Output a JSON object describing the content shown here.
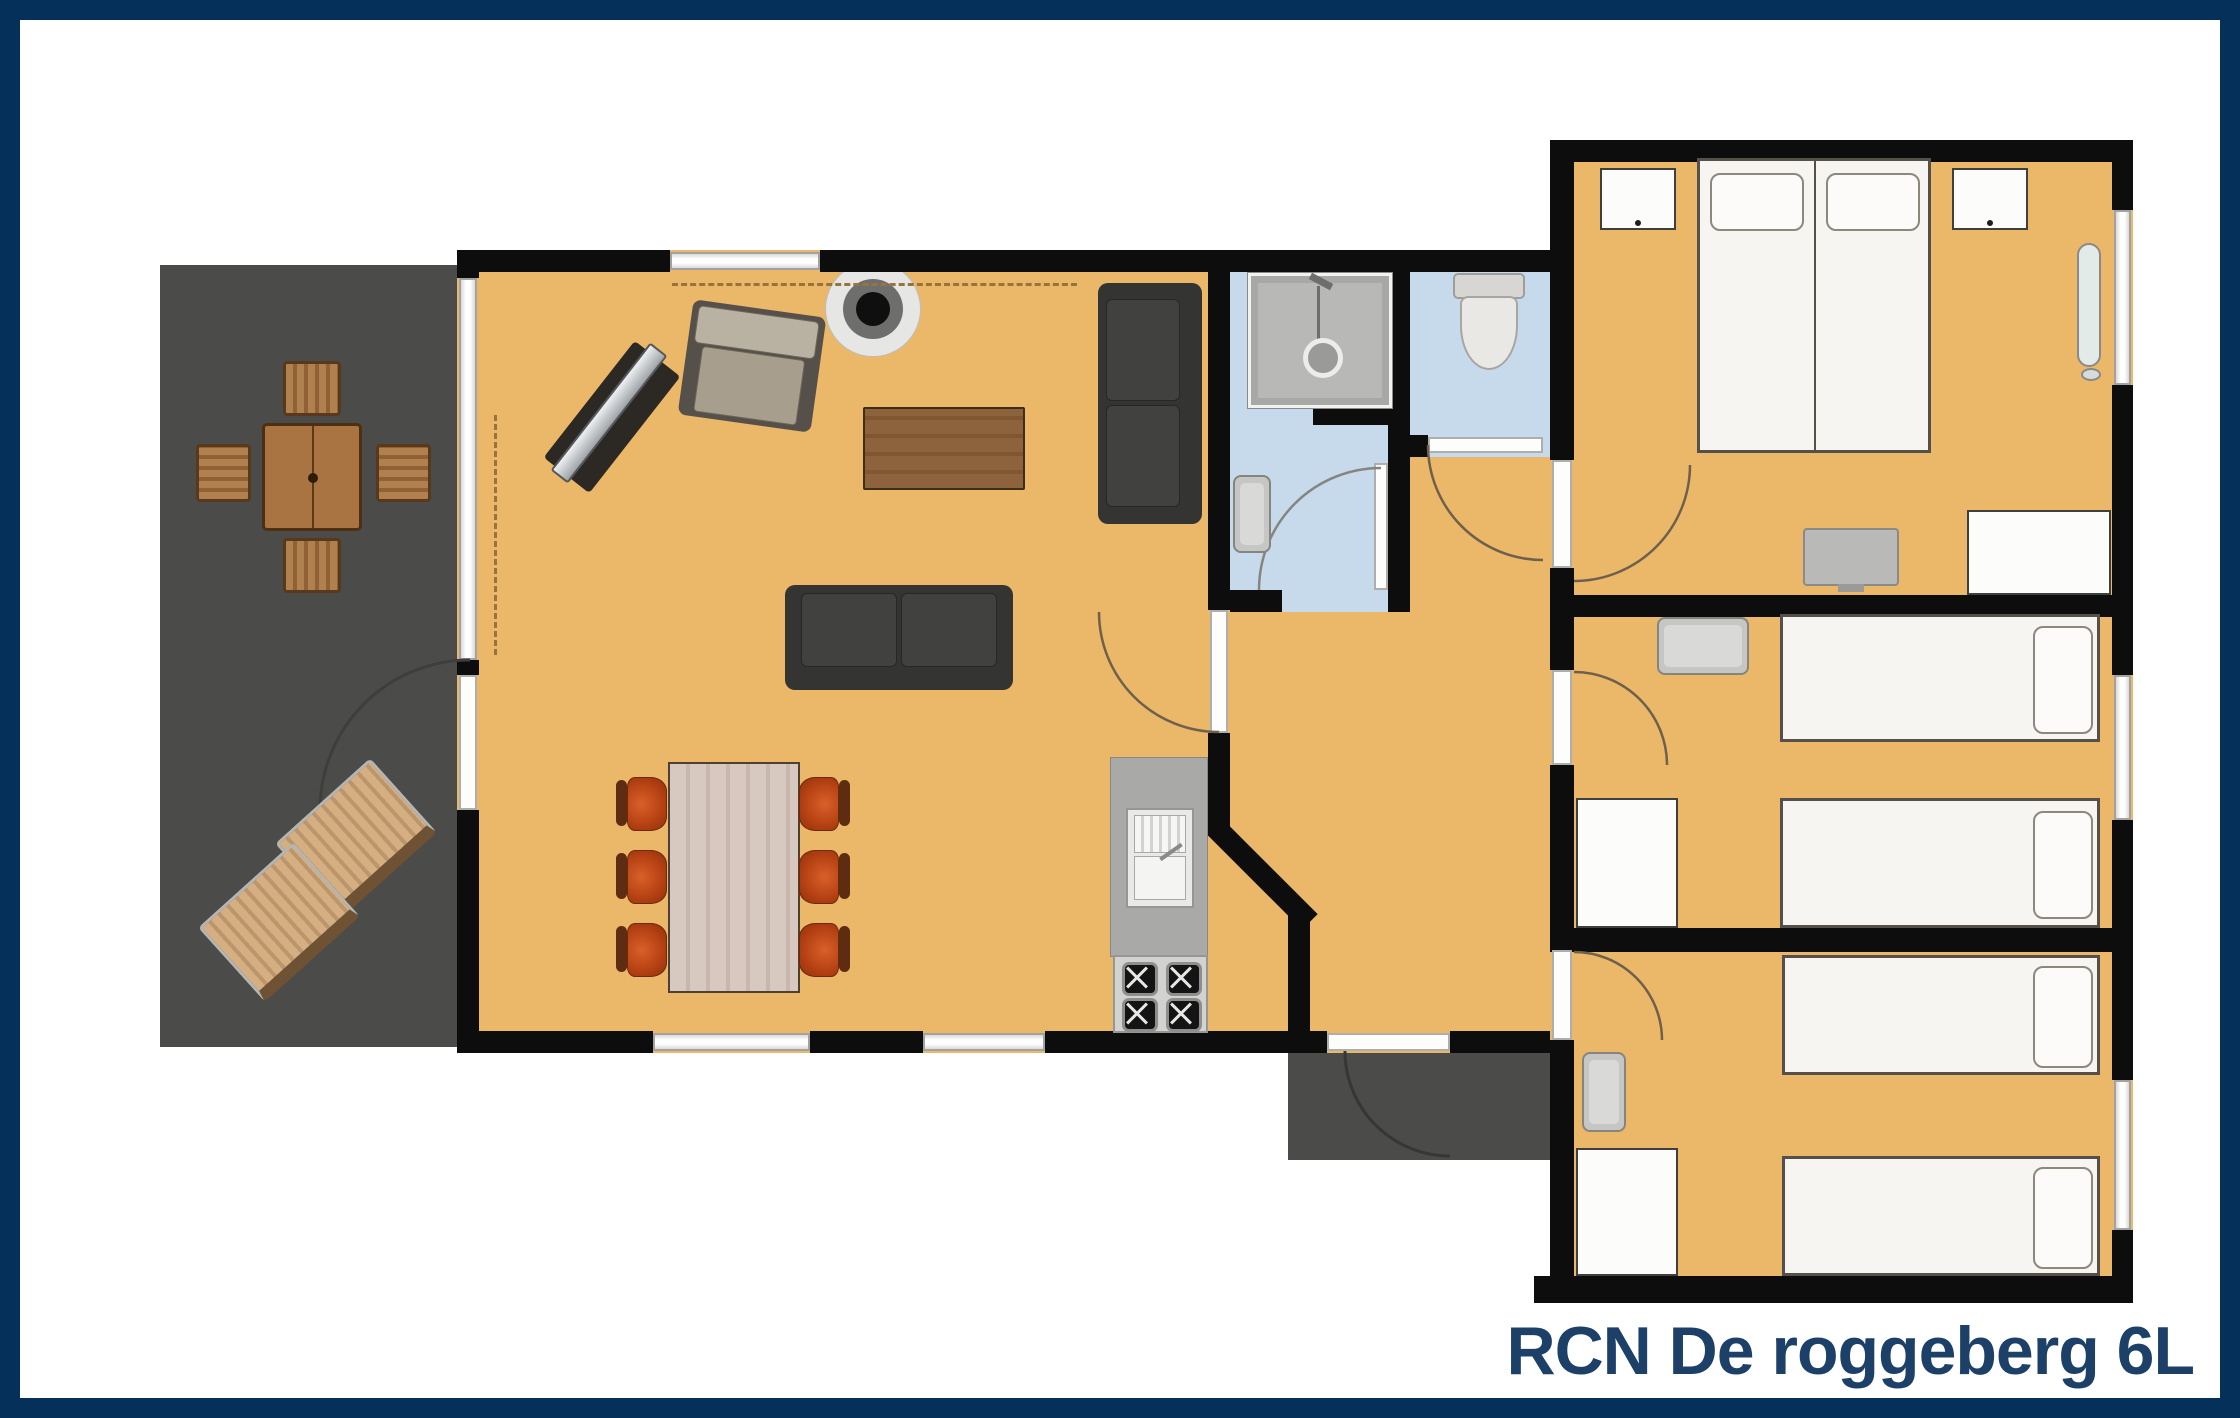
{
  "title": "RCN De roggeberg 6L",
  "colors": {
    "frame_border": "#05305a",
    "title_text": "#1d4068",
    "floor_orange": "#ebb869",
    "terrace_gray": "#4b4b49",
    "wall_black": "#0d0d0d",
    "wet_room_blue": "#c7daec",
    "dining_chair_red": "#b84314",
    "sofa_dark": "#343432",
    "wood_brown": "#8c633c"
  },
  "plan": {
    "outdoor": {
      "terrace_items": [
        "garden-table",
        "garden-chair",
        "garden-chair",
        "garden-chair",
        "garden-chair",
        "sun-lounger",
        "sun-lounger"
      ],
      "porch_items": [
        "entry-door-swing"
      ]
    },
    "living_room_items": [
      "tv-unit",
      "armchair",
      "wood-stove",
      "coffee-table",
      "wall-sofa",
      "two-seat-sofa",
      "dining-table",
      "dining-chairs-x6",
      "kitchen-counter",
      "kitchen-sink",
      "cooktop-4-burners"
    ],
    "bathroom_items": [
      "shower",
      "wash-basin"
    ],
    "toilet_room_items": [
      "toilet"
    ],
    "bedroom_1_items": [
      "double-bed",
      "pillow",
      "pillow",
      "nightstand",
      "nightstand",
      "radiator",
      "tv",
      "dresser"
    ],
    "bedroom_2_items": [
      "single-bed",
      "single-bed",
      "wash-basin",
      "wardrobe"
    ],
    "bedroom_3_items": [
      "single-bed",
      "single-bed",
      "wash-basin",
      "wardrobe"
    ]
  }
}
